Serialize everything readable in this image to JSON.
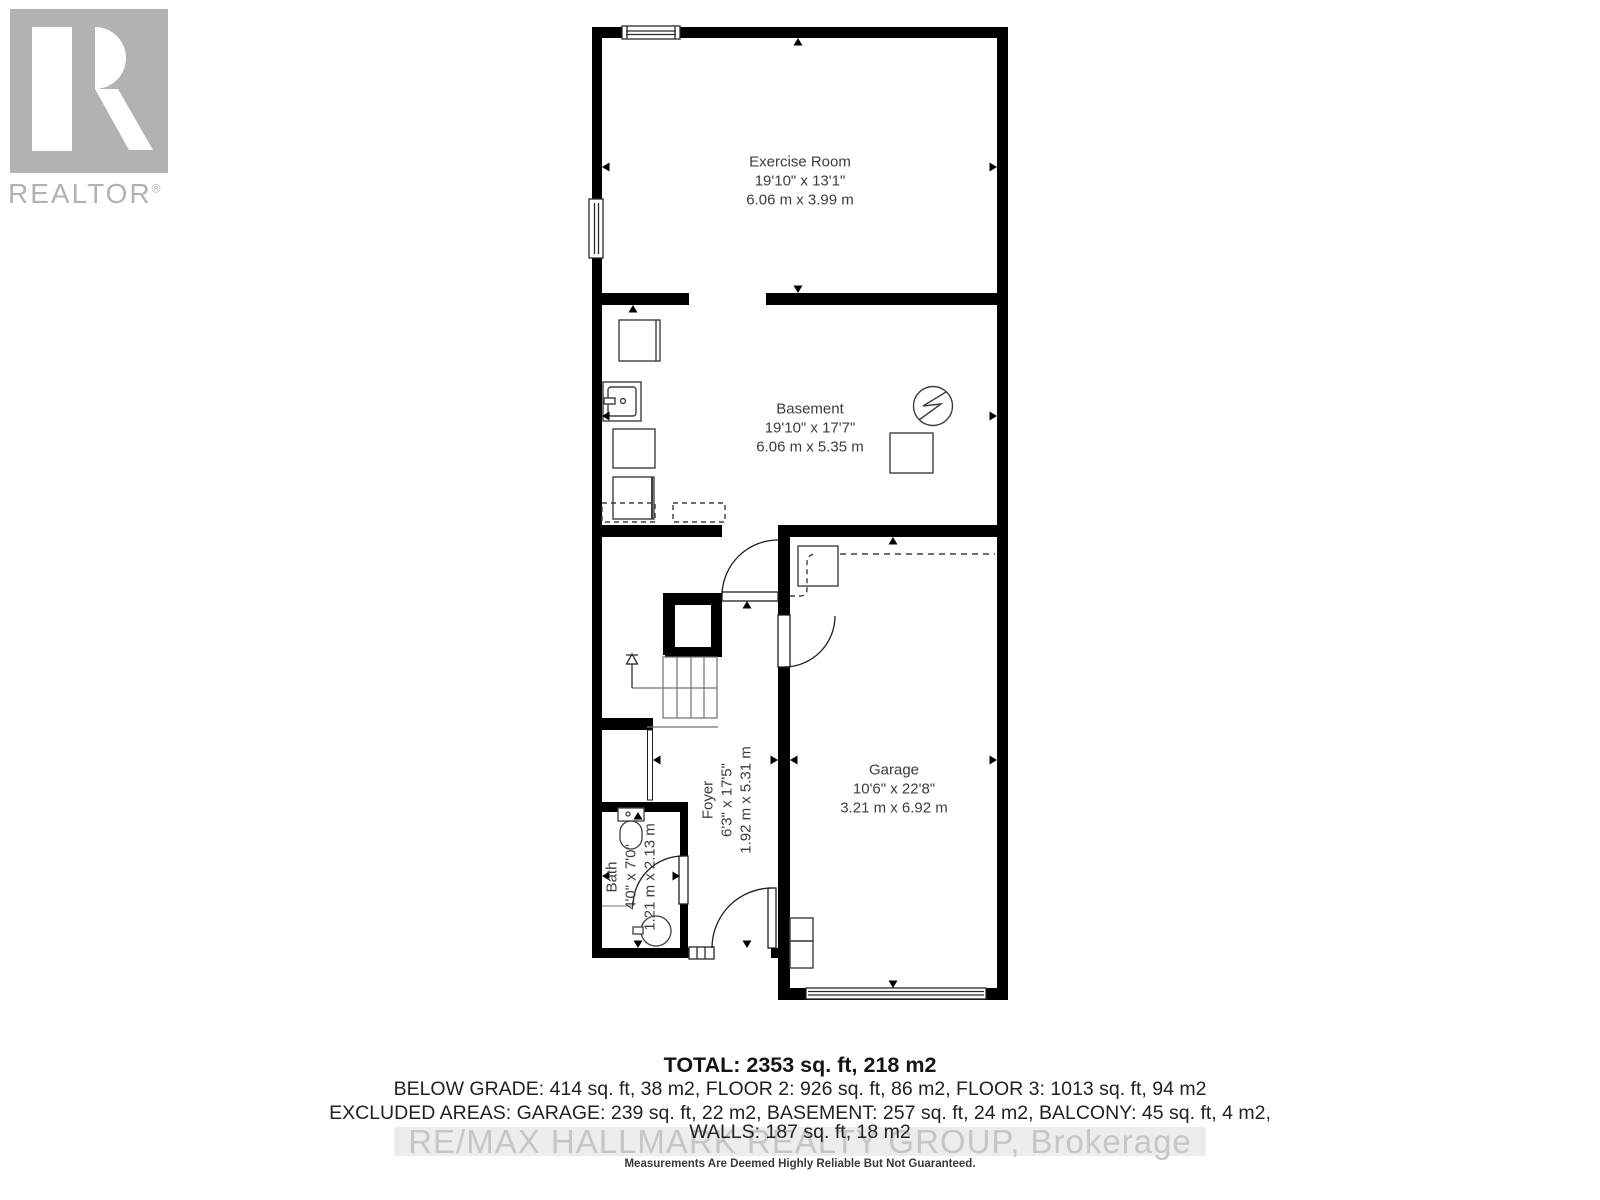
{
  "logo": {
    "text": "REALTOR",
    "reg": "®"
  },
  "rooms": [
    {
      "name": "Exercise Room",
      "imperial": "19'10\" x 13'1\"",
      "metric": "6.06 m x 3.99 m"
    },
    {
      "name": "Basement",
      "imperial": "19'10\" x 17'7\"",
      "metric": "6.06 m x 5.35 m"
    },
    {
      "name": "Garage",
      "imperial": "10'6\" x 22'8\"",
      "metric": "3.21 m x 6.92 m"
    },
    {
      "name": "Foyer",
      "imperial": "6'3\" x 17'5\"",
      "metric": "1.92 m x 5.31 m"
    },
    {
      "name": "Bath",
      "imperial": "4'0\" x 7'0\"",
      "metric": "1.21 m x 2.13 m"
    }
  ],
  "footer": {
    "total": "TOTAL: 2353 sq. ft, 218 m2",
    "grades": "BELOW GRADE: 414 sq. ft, 38 m2, FLOOR 2: 926 sq. ft, 86 m2, FLOOR 3: 1013 sq. ft, 94 m2",
    "excluded": "EXCLUDED AREAS: GARAGE: 239 sq. ft, 22 m2, BASEMENT: 257 sq. ft, 24 m2, BALCONY: 45 sq. ft, 4 m2,",
    "walls": "WALLS: 187 sq. ft, 18 m2",
    "watermark": "RE/MAX HALLMARK REALTY GROUP, Brokerage",
    "disclaimer": "Measurements Are Deemed Highly Reliable But Not Guaranteed."
  },
  "colors": {
    "wall": "#000000",
    "label": "#3d3d3d",
    "logo_gray": "#b2b2b2",
    "watermark_text": "#c6c6c6",
    "watermark_band": "#ededed"
  }
}
